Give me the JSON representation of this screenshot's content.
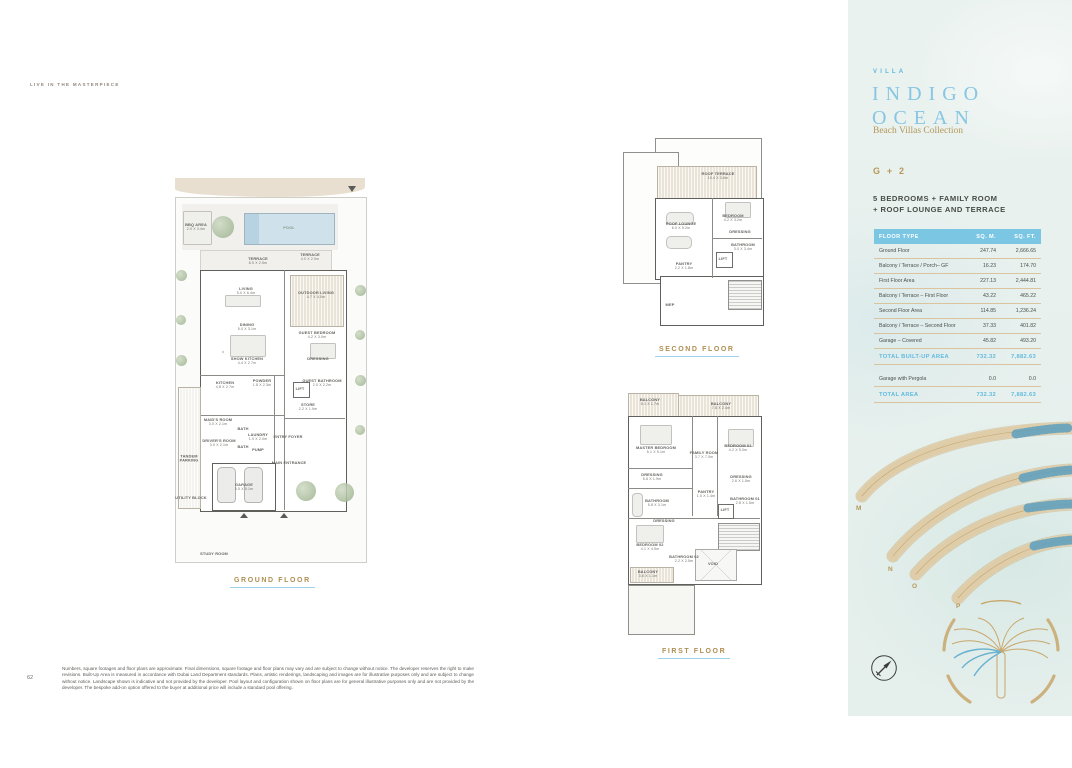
{
  "page": {
    "eyebrow": "LIVE IN THE MASTERPIECE",
    "page_number": "62",
    "disclaimer": "Numbers, square footages and floor plans are approximate. Final dimensions, square footage and floor plans may vary and are subject to change without notice. The developer reserves the right to make revisions. Built-Up Area is measured in accordance with Dubai Land Department standards. Plans, artistic renderings, landscaping and images are for illustrative purposes only and are subject to change without notice. Landscape shown is indicative and not provided by the developer. Pool layout and configuration shown on floor plans are for general illustrative purposes only and are not provided by the developer. The bespoke add-on option offered to the buyer at additional price will include a standard pool offering."
  },
  "panel": {
    "brand_eyebrow": "VILLA",
    "title_line1": "INDIGO",
    "title_line2": "OCEAN",
    "subtitle": "Beach Villas Collection",
    "type_code": "G + 2",
    "config_line1": "5 BEDROOMS + FAMILY ROOM",
    "config_line2": "+ ROOF LOUNGE AND TERRACE",
    "colors": {
      "accent_blue": "#7bc6e3",
      "accent_gold": "#b5985a",
      "text_dark": "#4a4f49"
    },
    "table": {
      "headers": [
        "FLOOR TYPE",
        "SQ. M.",
        "SQ. FT."
      ],
      "rows": [
        {
          "type": "Ground Floor",
          "sqm": "247.74",
          "sqft": "2,666.65"
        },
        {
          "type": "Balcony / Terrace / Porch– GF",
          "sqm": "16.23",
          "sqft": "174.70"
        },
        {
          "type": "First Floor Area",
          "sqm": "227.13",
          "sqft": "2,444.81"
        },
        {
          "type": "Balcony / Terrace – First Floor",
          "sqm": "43.22",
          "sqft": "465.22"
        },
        {
          "type": "Second Floor Area",
          "sqm": "114.85",
          "sqft": "1,236.24"
        },
        {
          "type": "Balcony / Terrace – Second Floor",
          "sqm": "37.33",
          "sqft": "401.82"
        },
        {
          "type": "Garage – Covered",
          "sqm": "45.82",
          "sqft": "493.20"
        }
      ],
      "total_built_up": {
        "label": "TOTAL BUILT-UP AREA",
        "sqm": "732.32",
        "sqft": "7,882.63"
      },
      "extra_row": {
        "label": "Garage with Pergola",
        "sqm": "0.0",
        "sqft": "0.0"
      },
      "total_area": {
        "label": "TOTAL AREA",
        "sqm": "732.32",
        "sqft": "7,882.63"
      }
    },
    "site_plan": {
      "frond_labels": [
        "M",
        "N",
        "O",
        "P"
      ]
    }
  },
  "plans": {
    "ground": {
      "caption": "GROUND FLOOR",
      "rooms": [
        {
          "label": "BBQ AREA",
          "dims": "2.0 X 3.4m"
        },
        {
          "label": "POOL",
          "dims": ""
        },
        {
          "label": "TERRACE",
          "dims": "8.5 X 2.5m"
        },
        {
          "label": "TERRACE",
          "dims": "4.0 X 2.0m"
        },
        {
          "label": "LIVING",
          "dims": "5.0 X 6.4m"
        },
        {
          "label": "OUTDOOR LIVING",
          "dims": "4.7 X 4.0m"
        },
        {
          "label": "DINING",
          "dims": "5.0 X 3.1m"
        },
        {
          "label": "GUEST BEDROOM",
          "dims": "4.2 X 3.0m"
        },
        {
          "label": "SHOW KITCHEN",
          "dims": "4.4 X 2.7m"
        },
        {
          "label": "DRESSING",
          "dims": ""
        },
        {
          "label": "KITCHEN",
          "dims": "4.8 X 2.7m"
        },
        {
          "label": "POWDER",
          "dims": "1.8 X 2.3m"
        },
        {
          "label": "GUEST BATHROOM",
          "dims": "2.0 X 2.2m"
        },
        {
          "label": "LIFT",
          "dims": ""
        },
        {
          "label": "STORE",
          "dims": "2.2 X 1.9m"
        },
        {
          "label": "MAID'S ROOM",
          "dims": "3.0 X 2.1m"
        },
        {
          "label": "BATH",
          "dims": ""
        },
        {
          "label": "DRIVER'S ROOM",
          "dims": "3.0 X 2.1m"
        },
        {
          "label": "BATH",
          "dims": ""
        },
        {
          "label": "LAUNDRY",
          "dims": "1.9 X 2.0m"
        },
        {
          "label": "PUMP",
          "dims": ""
        },
        {
          "label": "ENTRY FOYER",
          "dims": ""
        },
        {
          "label": "MAIN ENTRANCE",
          "dims": ""
        },
        {
          "label": "TANDEM PARKING",
          "dims": ""
        },
        {
          "label": "GARAGE",
          "dims": "5.5 X 5.1m"
        },
        {
          "label": "UTILITY BLOCK",
          "dims": ""
        },
        {
          "label": "STUDY ROOM",
          "dims": ""
        }
      ]
    },
    "second": {
      "caption": "SECOND FLOOR",
      "rooms": [
        {
          "label": "ROOF TERRACE",
          "dims": "10.4 X 3.6m"
        },
        {
          "label": "ROOF LOUNGE",
          "dims": "6.0 X 5.2m"
        },
        {
          "label": "BEDROOM",
          "dims": "4.2 X 3.2m"
        },
        {
          "label": "DRESSING",
          "dims": ""
        },
        {
          "label": "BATHROOM",
          "dims": "3.0 X 3.4m"
        },
        {
          "label": "LIFT",
          "dims": ""
        },
        {
          "label": "PANTRY",
          "dims": "2.2 X 1.8m"
        },
        {
          "label": "MEP",
          "dims": ""
        }
      ]
    },
    "first": {
      "caption": "FIRST FLOOR",
      "rooms": [
        {
          "label": "BALCONY",
          "dims": "6.1 X 1.7m"
        },
        {
          "label": "BALCONY",
          "dims": "7.8 X 2.4m"
        },
        {
          "label": "MASTER BEDROOM",
          "dims": "5.1 X 5.1m"
        },
        {
          "label": "FAMILY ROOM",
          "dims": "3.7 X 7.0m"
        },
        {
          "label": "BEDROOM 01",
          "dims": "4.2 X 5.0m"
        },
        {
          "label": "DRESSING",
          "dims": "5.6 X 1.9m"
        },
        {
          "label": "DRESSING",
          "dims": "2.6 X 1.5m"
        },
        {
          "label": "BATHROOM",
          "dims": "5.8 X 3.1m"
        },
        {
          "label": "PANTRY",
          "dims": "1.0 X 1.4m"
        },
        {
          "label": "BATHROOM 01",
          "dims": "2.8 X 1.5m"
        },
        {
          "label": "LIFT",
          "dims": ""
        },
        {
          "label": "DRESSING",
          "dims": ""
        },
        {
          "label": "BEDROOM 02",
          "dims": "4.1 X 4.5m"
        },
        {
          "label": "BATHROOM 02",
          "dims": "2.2 X 2.5m"
        },
        {
          "label": "BALCONY",
          "dims": "3.6 X 1.1m"
        },
        {
          "label": "VOID",
          "dims": ""
        }
      ]
    }
  }
}
